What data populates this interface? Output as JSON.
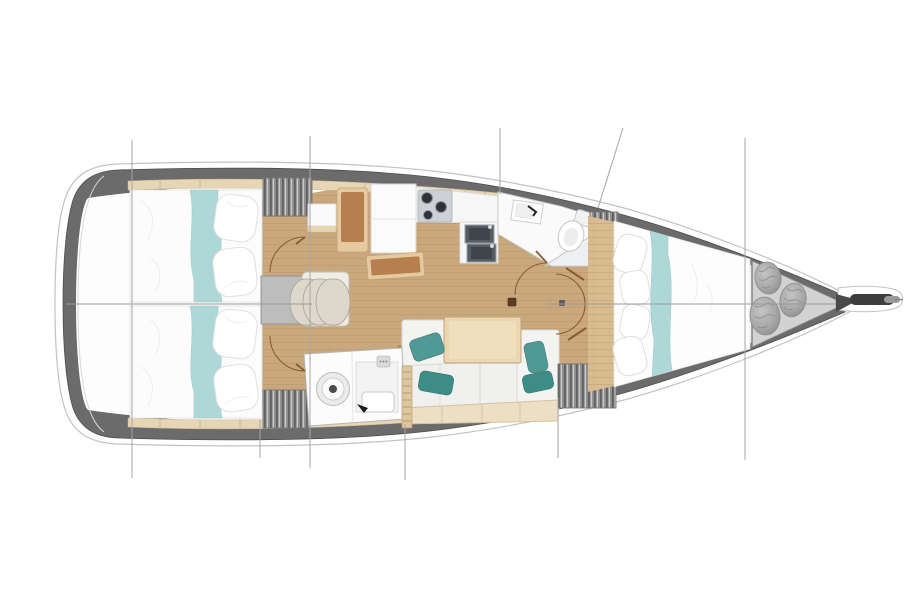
{
  "meta": {
    "title": "Sailboat interior floor plan (top view)",
    "orientation": "bow-right",
    "canvas": {
      "width": 909,
      "height": 600,
      "background": "#ffffff"
    }
  },
  "palette": {
    "hull_band": "#6b6b6b",
    "hull_outline": "#c2c2c2",
    "interior": "#fdfdfd",
    "wood_floor": "#c9a87d",
    "wood_light": "#d8bc90",
    "shelf_wood": "#e7d6b6",
    "table_wood": "#ead6b0",
    "furniture_brown": "#b5804e",
    "furniture_trim": "#e5c9a0",
    "teal_runner": "#aed7d8",
    "teal_pillow": "#4f9a94",
    "teal_pillow_dark": "#3d8c86",
    "locker_hatch": "#9e9e9e",
    "platform_gray": "#bdbdbd",
    "bow_locker_gray": "#d2d2d2",
    "bag_gray": "#b3b3b3",
    "sink_steel": "#565c63",
    "stove_panel": "#cdd1d5",
    "door_arc": "#8a5c35",
    "rig_line": "#a6a6a6"
  },
  "rooms": {
    "aft_cabin_port": {
      "label": "Aft cabin port with double berth and teal runner"
    },
    "aft_cabin_starboard": {
      "label": "Aft cabin starboard with double berth and teal runner"
    },
    "companionway": {
      "label": "Companionway stairs with three steps",
      "steps": 3
    },
    "nav_station": {
      "label": "Navigation station with seat and chart table"
    },
    "galley": {
      "label": "Galley with three-burner stove and double sink",
      "burners": 3,
      "sinks": 2
    },
    "head_forward": {
      "label": "Forward head with sink, toilet and shower"
    },
    "head_aft": {
      "label": "Aft head with washer drum, shower tray and basin"
    },
    "salon": {
      "label": "Salon with sofa, wood table and teal cushions",
      "pillows": 4
    },
    "forward_cabin": {
      "label": "Forward V-berth cabin with teal runner"
    },
    "bow_locker": {
      "label": "Bow sail locker with three stowed bags",
      "bags": 3
    },
    "bowsprit": {
      "label": "Bowsprit with anchor roller"
    },
    "rigging": {
      "label": "Standing rigging reference lines"
    }
  }
}
